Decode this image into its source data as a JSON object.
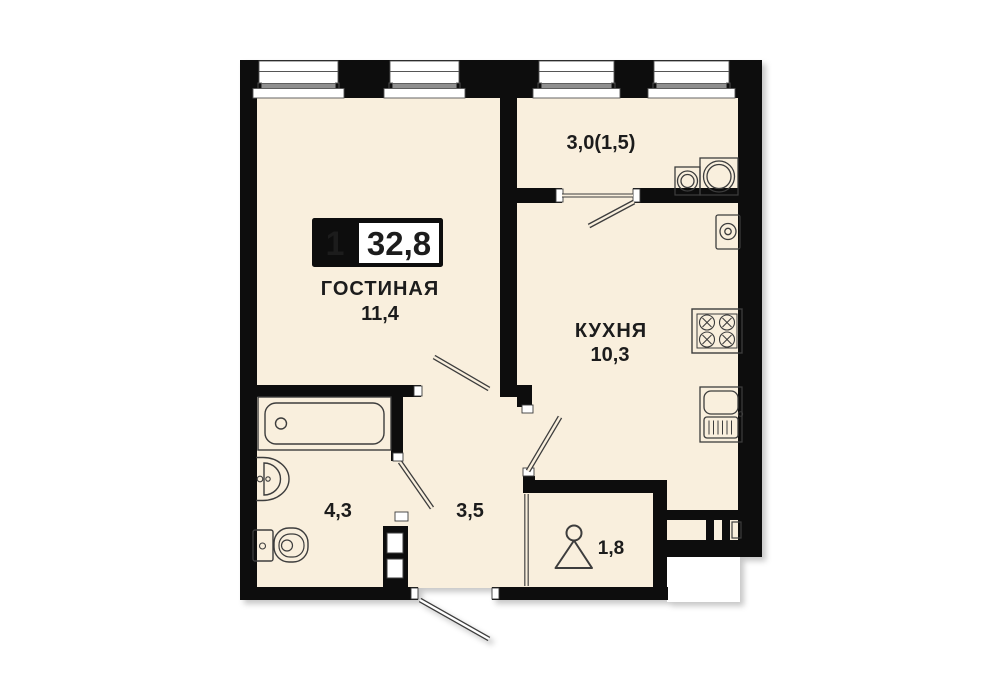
{
  "plan": {
    "badge": {
      "rooms_count": "1",
      "total_area": "32,8"
    },
    "rooms": [
      {
        "key": "living",
        "name": "ГОСТИНАЯ",
        "area": "11,4"
      },
      {
        "key": "kitchen",
        "name": "КУХНЯ",
        "area": "10,3"
      },
      {
        "key": "balcony",
        "name": "",
        "area": "3,0(1,5)"
      },
      {
        "key": "bathroom",
        "name": "",
        "area": "4,3"
      },
      {
        "key": "hallway",
        "name": "",
        "area": "3,5"
      },
      {
        "key": "wardrobe",
        "name": "",
        "area": "1,8"
      }
    ],
    "colors": {
      "wall": "#0b0b0b",
      "floor": "#f9efdd",
      "background": "#ffffff",
      "fixture_line": "#3d3d3d",
      "text": "#1c1c1c",
      "window_band": "#8f8f8f"
    },
    "icons": [
      "window-icon",
      "bathtub-icon",
      "washbasin-icon",
      "toilet-icon",
      "washing-machine-icon",
      "dryer-icon",
      "water-heater-icon",
      "stove-icon",
      "kitchen-sink-icon",
      "hanger-icon",
      "door-swing-icon",
      "sliding-door-icon",
      "vent-shaft-icon",
      "duct-icon"
    ]
  }
}
